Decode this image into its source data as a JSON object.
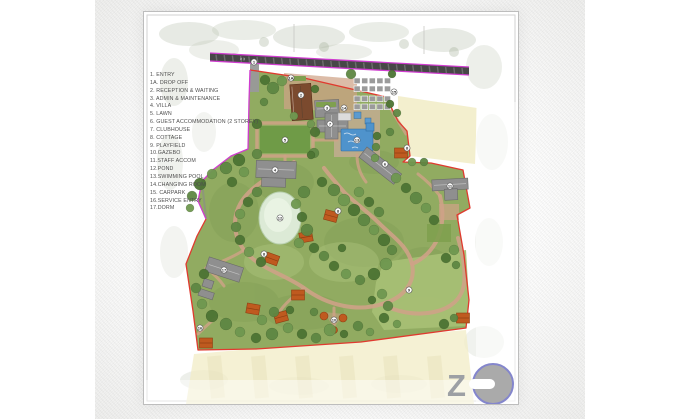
{
  "legend": {
    "items": [
      "1. ENTRY",
      "1A. DROP OFF",
      "2. RECEPTION & WAITING",
      "3. ADMIN & MAINTENANCE",
      "4. VILLA",
      "5. LAWN",
      "6. GUEST ACCOMMODATION (2 STOREY)",
      "7. CLUBHOUSE",
      "8. COTTAGE",
      "9. PLAYFIELD",
      "10.GAZEBO",
      "11.STAFF ACCOM",
      "12.POND",
      "13.SWIMMING POOL",
      "14.CHANGING ROOM",
      "15. CARPARK",
      "16.SERVICE ENTRY",
      "17.DORM"
    ]
  },
  "road": {
    "label": "# 3"
  },
  "markers": {
    "entry": "1",
    "drop_off": "1A",
    "reception": "2",
    "admin": "3",
    "villa": "4",
    "lawn": "5",
    "guest_accommodation": "6",
    "clubhouse": "7",
    "cottage_a": "8",
    "cottage_b": "8",
    "cottage_c": "8",
    "playfield": "9",
    "gazebo": "10",
    "staff_accom": "11",
    "pond": "12",
    "swimming_pool": "13",
    "changing_room": "14",
    "carpark": "15",
    "service_entry": "16",
    "dorm": "17"
  },
  "logo": {
    "letter": "Z"
  },
  "colors": {
    "boundary_red": "#e03a2f",
    "boundary_magenta": "#cf3ccf",
    "road": "#474747",
    "grass": "#91ab61",
    "path": "#cfa287",
    "pool_blue": "#4f93cc",
    "pond_green": "#dcead6",
    "roof_orange": "#bf5a1f",
    "roof_brown": "#7b4a2e",
    "roof_gray": "#8f8f8f",
    "field_yellow": "#f1ecc6",
    "logo_ring": "#8486cc",
    "logo_gray": "#aaaaaa"
  }
}
